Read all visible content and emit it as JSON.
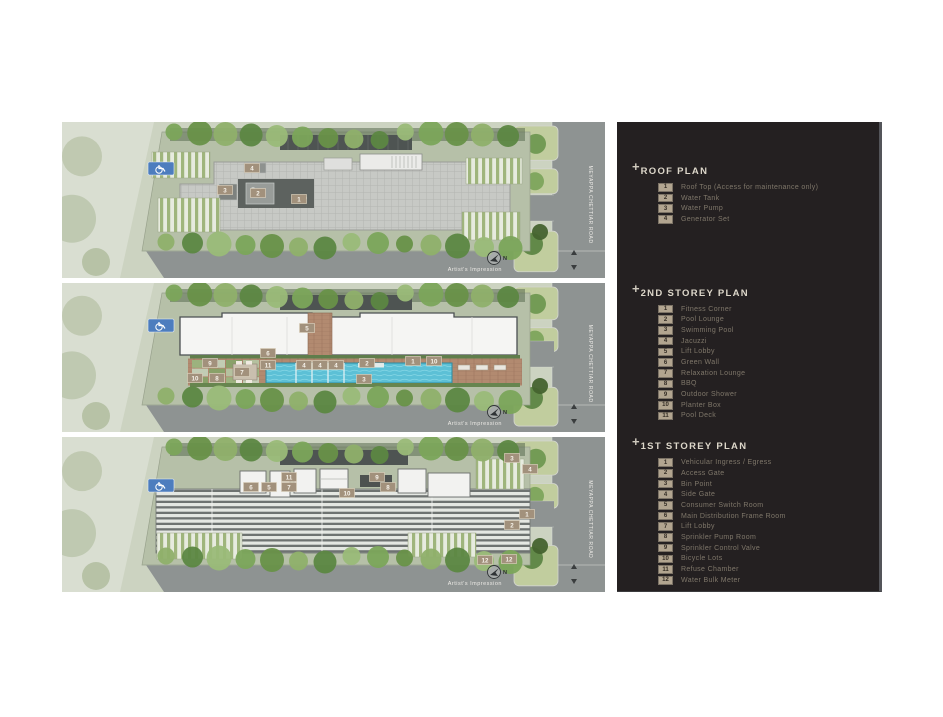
{
  "road_label": "MEYAPPA CHETTIAR ROAD",
  "artists_impression": "Artist's Impression",
  "compass_n": "N",
  "colors": {
    "legend_bg": "#242021",
    "badge": "#b2a590",
    "heading": "#ddd7ca",
    "item_text": "#7f776a",
    "grass": "#ccd3c1",
    "road": "#8e9392",
    "pool": "#5cc0d6",
    "deck_brick": "#b28a70",
    "marker": "#a2917c"
  },
  "legend": {
    "sections": [
      {
        "title": "ROOF PLAN",
        "items": [
          {
            "num": "1",
            "label": "Roof Top (Access for maintenance only)"
          },
          {
            "num": "2",
            "label": "Water Tank"
          },
          {
            "num": "3",
            "label": "Water Pump"
          },
          {
            "num": "4",
            "label": "Generator Set"
          }
        ]
      },
      {
        "title": "2ND STOREY PLAN",
        "items": [
          {
            "num": "1",
            "label": "Fitness Corner"
          },
          {
            "num": "2",
            "label": "Pool Lounge"
          },
          {
            "num": "3",
            "label": "Swimming Pool"
          },
          {
            "num": "4",
            "label": "Jacuzzi"
          },
          {
            "num": "5",
            "label": "Lift Lobby"
          },
          {
            "num": "6",
            "label": "Green Wall"
          },
          {
            "num": "7",
            "label": "Relaxation Lounge"
          },
          {
            "num": "8",
            "label": "BBQ"
          },
          {
            "num": "9",
            "label": "Outdoor Shower"
          },
          {
            "num": "10",
            "label": "Planter Box"
          },
          {
            "num": "11",
            "label": "Pool Deck"
          }
        ]
      },
      {
        "title": "1ST STOREY PLAN",
        "items": [
          {
            "num": "1",
            "label": "Vehicular Ingress / Egress"
          },
          {
            "num": "2",
            "label": "Access Gate"
          },
          {
            "num": "3",
            "label": "Bin Point"
          },
          {
            "num": "4",
            "label": "Side Gate"
          },
          {
            "num": "5",
            "label": "Consumer Switch Room"
          },
          {
            "num": "6",
            "label": "Main Distribution Frame Room"
          },
          {
            "num": "7",
            "label": "Lift Lobby"
          },
          {
            "num": "8",
            "label": "Sprinkler Pump Room"
          },
          {
            "num": "9",
            "label": "Sprinkler Control Valve"
          },
          {
            "num": "10",
            "label": "Bicycle Lots"
          },
          {
            "num": "11",
            "label": "Refuse Chamber"
          },
          {
            "num": "12",
            "label": "Water Bulk Meter"
          }
        ]
      }
    ]
  },
  "plans": [
    {
      "name": "roof-plan",
      "type": "roof",
      "h": 156,
      "accY": 40,
      "entY": 73,
      "markers": [
        {
          "n": "4",
          "x": 190,
          "y": 46
        },
        {
          "n": "3",
          "x": 163,
          "y": 68
        },
        {
          "n": "2",
          "x": 196,
          "y": 71
        },
        {
          "n": "1",
          "x": 237,
          "y": 77
        }
      ]
    },
    {
      "name": "second-storey-plan",
      "type": "second",
      "h": 149,
      "accY": 36,
      "entY": 58,
      "markers": [
        {
          "n": "5",
          "x": 245,
          "y": 45
        },
        {
          "n": "6",
          "x": 206,
          "y": 70
        },
        {
          "n": "11",
          "x": 206,
          "y": 82
        },
        {
          "n": "9",
          "x": 148,
          "y": 80
        },
        {
          "n": "10",
          "x": 133,
          "y": 95
        },
        {
          "n": "8",
          "x": 155,
          "y": 95
        },
        {
          "n": "7",
          "x": 180,
          "y": 89
        },
        {
          "n": "4",
          "x": 242,
          "y": 82
        },
        {
          "n": "4",
          "x": 258,
          "y": 82
        },
        {
          "n": "4",
          "x": 274,
          "y": 82
        },
        {
          "n": "2",
          "x": 305,
          "y": 80
        },
        {
          "n": "3",
          "x": 302,
          "y": 96
        },
        {
          "n": "1",
          "x": 351,
          "y": 78
        },
        {
          "n": "10",
          "x": 372,
          "y": 78
        }
      ]
    },
    {
      "name": "first-storey-plan",
      "type": "first",
      "h": 155,
      "accY": 42,
      "entY": 64,
      "markers": [
        {
          "n": "3",
          "x": 450,
          "y": 21
        },
        {
          "n": "4",
          "x": 468,
          "y": 32
        },
        {
          "n": "11",
          "x": 227,
          "y": 40
        },
        {
          "n": "6",
          "x": 189,
          "y": 50
        },
        {
          "n": "5",
          "x": 207,
          "y": 50
        },
        {
          "n": "7",
          "x": 227,
          "y": 50
        },
        {
          "n": "9",
          "x": 315,
          "y": 40
        },
        {
          "n": "8",
          "x": 326,
          "y": 50
        },
        {
          "n": "10",
          "x": 285,
          "y": 56
        },
        {
          "n": "1",
          "x": 465,
          "y": 77
        },
        {
          "n": "2",
          "x": 450,
          "y": 88
        },
        {
          "n": "12",
          "x": 423,
          "y": 123
        },
        {
          "n": "12",
          "x": 447,
          "y": 122
        }
      ]
    }
  ]
}
